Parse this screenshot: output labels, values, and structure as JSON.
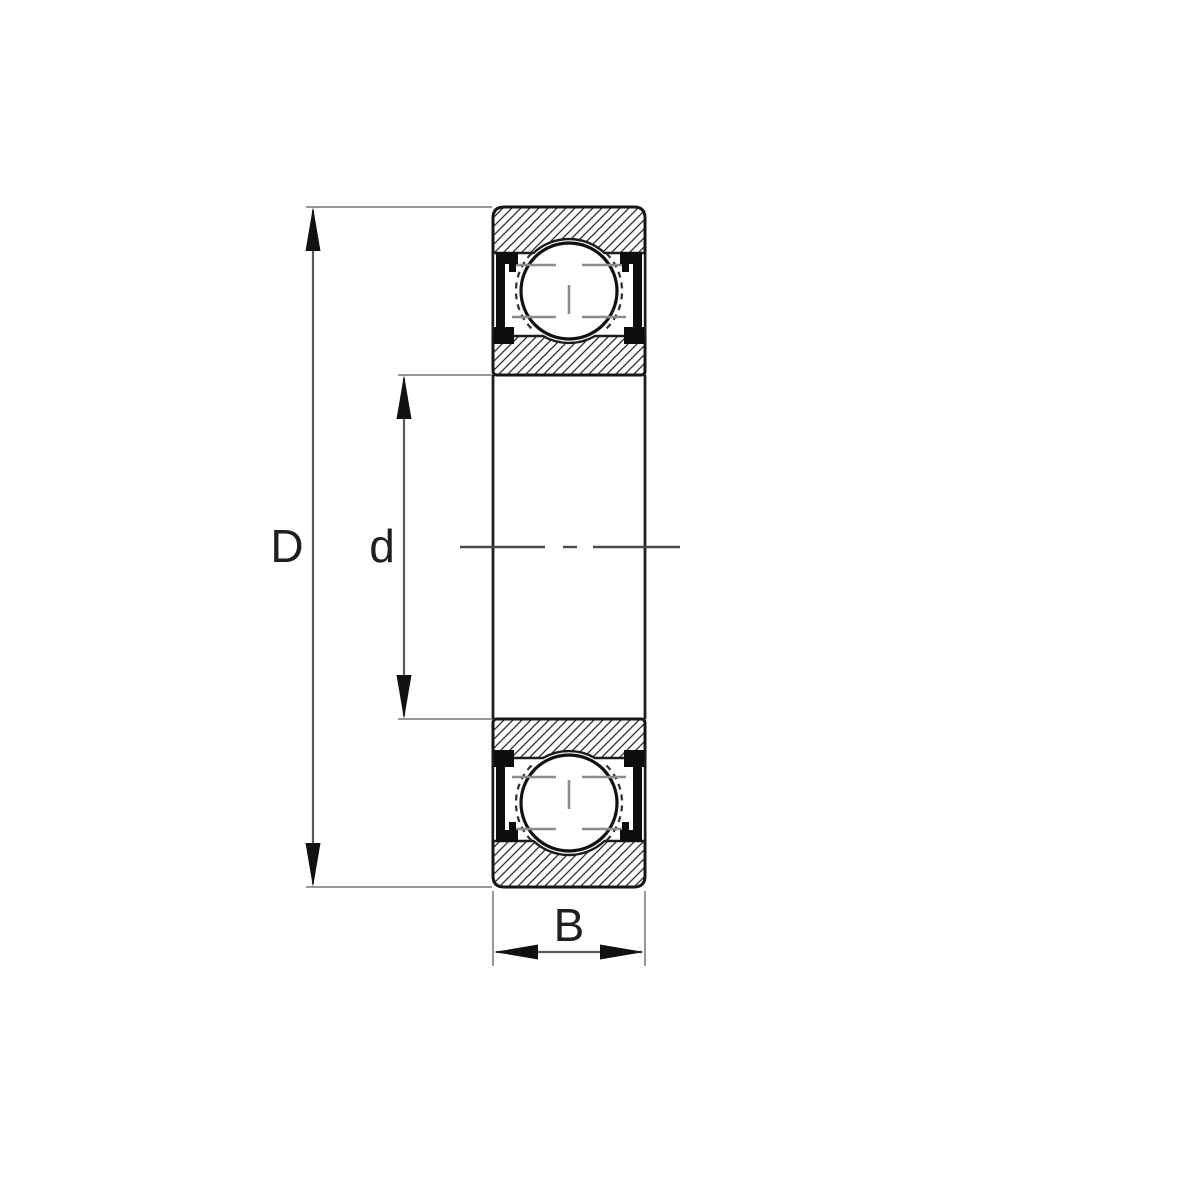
{
  "diagram": {
    "kind": "deep-groove-ball-bearing-cross-section",
    "dimension_labels": {
      "outer_diameter": {
        "label": "D"
      },
      "bore_diameter": {
        "label": "d"
      },
      "width": {
        "label": "B"
      }
    },
    "colors": {
      "background": "#ffffff",
      "outline": "#161616",
      "hatch": "#2a2a2a",
      "seal": "#0d0d0d",
      "dimension_line": "#5a5a5a",
      "extension_line": "#979797",
      "centerline": "#4a4a4a",
      "cage_mark": "#8c8c8c",
      "label_text": "#1f1f1f"
    }
  }
}
